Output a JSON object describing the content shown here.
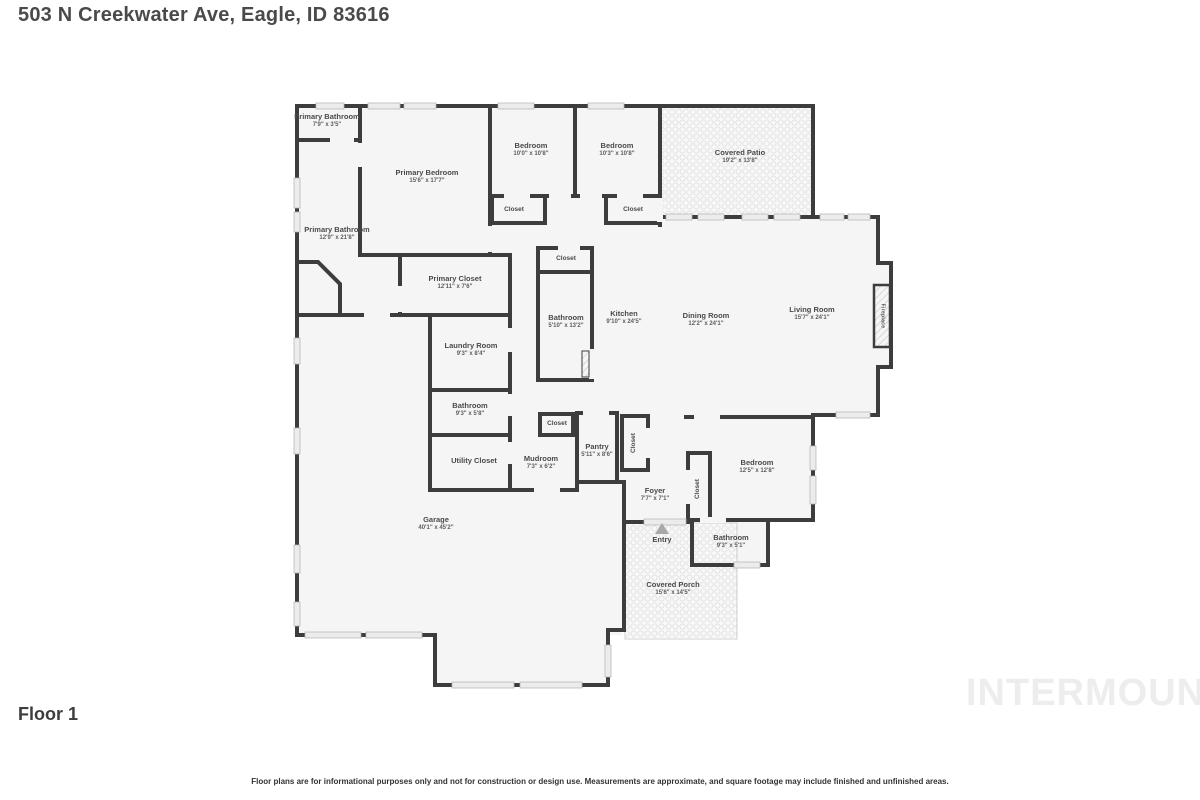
{
  "header": {
    "address": "503 N Creekwater Ave, Eagle, ID 83616"
  },
  "footer": {
    "floor_label": "Floor 1",
    "watermark": "INTERMOUNTAIN",
    "disclaimer": "Floor plans are for informational purposes only and not for construction or design use. Measurements are approximate, and square footage may include finished and unfinished areas."
  },
  "colors": {
    "wall": "#3d3d3d",
    "room_fill": "#f5f5f5",
    "outdoor_fill": "#f8f8f8",
    "window_fill": "#ececec",
    "label_text": "#4a4a4a",
    "watermark_text": "#ededed",
    "entry_arrow": "#a8a8a8"
  },
  "rooms": {
    "primary_bathroom_small": {
      "name": "Primary Bathroom",
      "dims": "7'9\" x 3'5\""
    },
    "primary_bedroom": {
      "name": "Primary Bedroom",
      "dims": "15'6\" x 17'7\""
    },
    "bedroom_1": {
      "name": "Bedroom",
      "dims": "10'0\" x 10'8\""
    },
    "bedroom_2": {
      "name": "Bedroom",
      "dims": "10'3\" x 10'8\""
    },
    "covered_patio": {
      "name": "Covered Patio",
      "dims": "19'2\" x 13'8\""
    },
    "closet_bedroom_1": {
      "name": "Closet"
    },
    "closet_bedroom_2": {
      "name": "Closet"
    },
    "primary_bathroom": {
      "name": "Primary Bathroom",
      "dims": "12'9\" x 21'8\""
    },
    "primary_closet": {
      "name": "Primary Closet",
      "dims": "12'11\" x 7'6\""
    },
    "closet_hall": {
      "name": "Closet"
    },
    "bathroom_hall": {
      "name": "Bathroom",
      "dims": "5'10\" x 13'2\""
    },
    "kitchen": {
      "name": "Kitchen",
      "dims": "9'10\" x 24'5\""
    },
    "dining_room": {
      "name": "Dining Room",
      "dims": "12'2\" x 24'1\""
    },
    "living_room": {
      "name": "Living Room",
      "dims": "15'7\" x 24'1\""
    },
    "fireplace": {
      "name": "Fireplace"
    },
    "laundry_room": {
      "name": "Laundry Room",
      "dims": "9'3\" x 8'4\""
    },
    "bathroom_laundry": {
      "name": "Bathroom",
      "dims": "9'3\" x 5'8\""
    },
    "utility_closet": {
      "name": "Utility Closet"
    },
    "closet_mudroom": {
      "name": "Closet"
    },
    "pantry": {
      "name": "Pantry",
      "dims": "5'11\" x 8'6\""
    },
    "closet_pantry": {
      "name": "Closet"
    },
    "mudroom": {
      "name": "Mudroom",
      "dims": "7'3\" x 6'2\""
    },
    "foyer": {
      "name": "Foyer",
      "dims": "7'7\" x 7'1\""
    },
    "closet_foyer": {
      "name": "Closet"
    },
    "bedroom_3": {
      "name": "Bedroom",
      "dims": "12'5\" x 12'8\""
    },
    "entry": {
      "name": "Entry"
    },
    "bathroom_entry": {
      "name": "Bathroom",
      "dims": "9'3\" x 5'1\""
    },
    "covered_porch": {
      "name": "Covered Porch",
      "dims": "15'6\" x 14'5\""
    },
    "garage": {
      "name": "Garage",
      "dims": "40'1\" x 45'2\""
    }
  }
}
